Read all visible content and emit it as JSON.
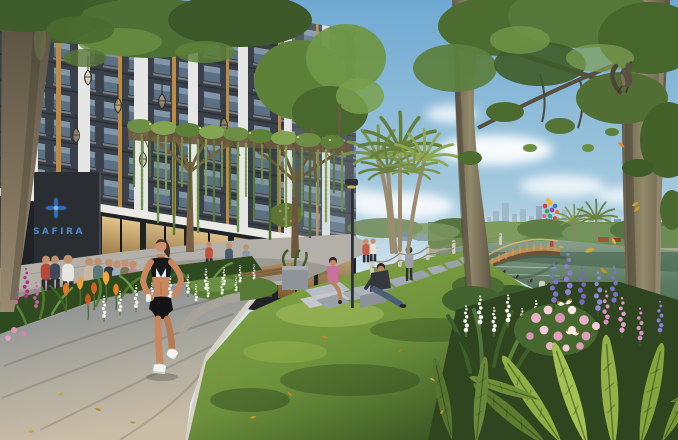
{
  "scene": {
    "kind": "architectural exterior render - lakeside park with jogger",
    "signage": {
      "building_sign": "SAFIRA"
    },
    "palette": {
      "sky_top": "#6fa9d2",
      "sky_horizon": "#dcebf3",
      "water": "#4c6a52",
      "lawn_sunlit": "#8fae4d",
      "lawn_shadow": "#3c5a28",
      "facade_dark": "#3a4049",
      "facade_light": "#e6e7e4",
      "bridge_wood": "#bb915b",
      "sign_blue": "#4f86c4",
      "logo_blue": "#2f6cc0",
      "lupine_purple": "#7a72cc",
      "lupine_pink": "#d892c0",
      "rose_pink": "#e8afc6",
      "tulip_orange": "#e07728",
      "gold_leaf": "#d4a232",
      "path_warm": "#c9bda6",
      "path_cool": "#7e858d"
    },
    "balloons": {
      "colors": [
        "#d94338",
        "#f2b630",
        "#3a7bd0",
        "#46a046",
        "#8a4fc0",
        "#f07820",
        "#e06a9a",
        "#2fa0a8",
        "#d94338",
        "#f2b630",
        "#3a7bd0",
        "#46a046"
      ]
    }
  }
}
